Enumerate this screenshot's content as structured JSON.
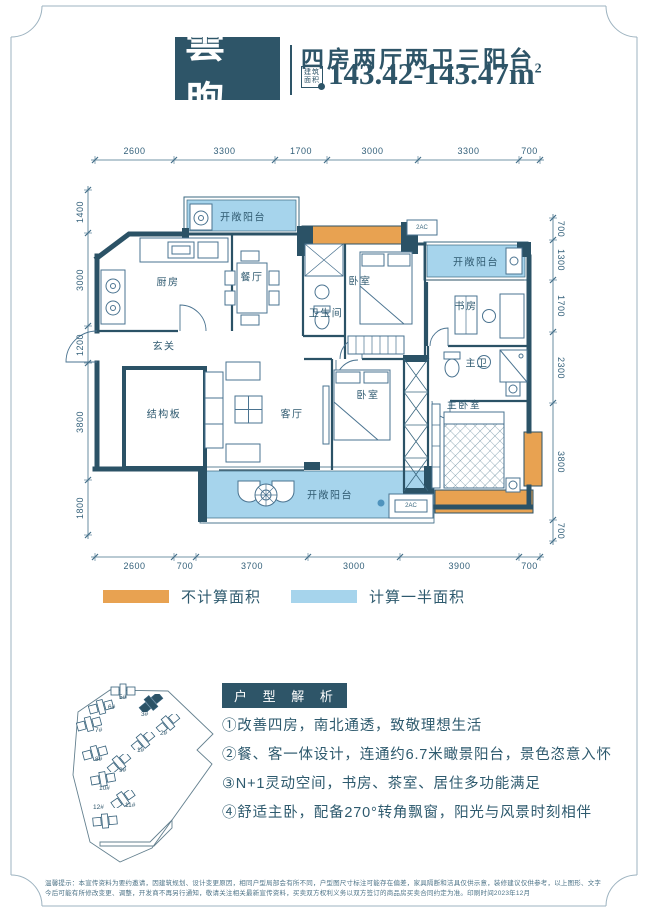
{
  "header": {
    "logo": "雲煦",
    "title": "四房两厅两卫三阳台",
    "badge_top": "建筑",
    "badge_bottom": "面积",
    "area": "143.42-143.47m",
    "area_sup": "2"
  },
  "plan": {
    "dims": {
      "top": {
        "y": 160,
        "ticks": [
          95,
          174,
          275,
          327,
          418,
          519,
          540
        ],
        "labels": [
          "2600",
          "3300",
          "1700",
          "3000",
          "3300",
          "700"
        ]
      },
      "bottom": {
        "y": 557,
        "ticks": [
          95,
          174,
          196,
          308,
          400,
          519,
          540
        ],
        "labels": [
          "2600",
          "700",
          "3700",
          "3000",
          "3900",
          "700"
        ]
      },
      "left": {
        "x": 88,
        "ticks": [
          190,
          233,
          326,
          363,
          480,
          535
        ],
        "labels": [
          "1400",
          "3000",
          "1200",
          "3800",
          "1800"
        ]
      },
      "right": {
        "x": 553,
        "ticks": [
          218,
          240,
          280,
          332,
          403,
          520,
          541
        ],
        "labels": [
          "700",
          "1300",
          "1700",
          "2300",
          "3800",
          "700"
        ]
      }
    },
    "rooms": [
      {
        "t": "开敞阳台",
        "x": 243,
        "y": 216
      },
      {
        "t": "厨房",
        "x": 168,
        "y": 281
      },
      {
        "t": "餐厅",
        "x": 252,
        "y": 276
      },
      {
        "t": "卧室",
        "x": 360,
        "y": 280
      },
      {
        "t": "卫生间",
        "x": 326,
        "y": 312
      },
      {
        "t": "开敞阳台",
        "x": 476,
        "y": 261
      },
      {
        "t": "书房",
        "x": 466,
        "y": 305
      },
      {
        "t": "玄关",
        "x": 164,
        "y": 345
      },
      {
        "t": "结构板",
        "x": 164,
        "y": 413
      },
      {
        "t": "客厅",
        "x": 292,
        "y": 413
      },
      {
        "t": "卧室",
        "x": 368,
        "y": 394
      },
      {
        "t": "主卫",
        "x": 477,
        "y": 362
      },
      {
        "t": "主卧室",
        "x": 464,
        "y": 404
      },
      {
        "t": "开敞阳台",
        "x": 330,
        "y": 494
      },
      {
        "t": "2AC",
        "x": 422,
        "y": 228,
        "s": 1
      },
      {
        "t": "2AC",
        "x": 411,
        "y": 506,
        "s": 1
      }
    ]
  },
  "legend": [
    {
      "color": "#e8a251",
      "label": "不计算面积"
    },
    {
      "color": "#a6d4ec",
      "label": "计算一半面积"
    }
  ],
  "site": {
    "buildings": [
      {
        "t": "5#",
        "lx": 119,
        "ly": 694,
        "ix": 110,
        "iy": 682,
        "rot": 0,
        "dark": false
      },
      {
        "t": "6#",
        "lx": 108,
        "ly": 704,
        "ix": 88,
        "iy": 698,
        "rot": -15,
        "dark": false
      },
      {
        "t": "3#",
        "lx": 141,
        "ly": 711,
        "ix": 138,
        "iy": 694,
        "rot": -40,
        "dark": true
      },
      {
        "t": "2#",
        "lx": 160,
        "ly": 730,
        "ix": 155,
        "iy": 714,
        "rot": -40,
        "dark": false
      },
      {
        "t": "7#",
        "lx": 95,
        "ly": 727,
        "ix": 76,
        "iy": 715,
        "rot": -15,
        "dark": false
      },
      {
        "t": "1#",
        "lx": 137,
        "ly": 747,
        "ix": 130,
        "iy": 732,
        "rot": -40,
        "dark": false
      },
      {
        "t": "8#",
        "lx": 95,
        "ly": 756,
        "ix": 82,
        "iy": 744,
        "rot": -15,
        "dark": false
      },
      {
        "t": "9#",
        "lx": 119,
        "ly": 767,
        "ix": 106,
        "iy": 754,
        "rot": -40,
        "dark": false
      },
      {
        "t": "10#",
        "lx": 99,
        "ly": 785,
        "ix": 90,
        "iy": 770,
        "rot": -10,
        "dark": false
      },
      {
        "t": "11#",
        "lx": 125,
        "ly": 802,
        "ix": 110,
        "iy": 790,
        "rot": -35,
        "dark": false
      },
      {
        "t": "12#",
        "lx": 93,
        "ly": 804,
        "ix": 92,
        "iy": 812,
        "rot": -5,
        "dark": false
      }
    ]
  },
  "analysis": {
    "title": "户 型 解 析",
    "items": [
      "①改善四房，南北通透，致敬理想生活",
      "②餐、客一体设计，连通约6.7米瞰景阳台，景色恣意入怀",
      "③N+1灵动空间，书房、茶室、居住多功能满足",
      "④舒适主卧，配备270°转角飘窗，阳光与风景时刻相伴"
    ]
  },
  "disclaimer": "温馨提示：本宣传资料为要约邀请，因建筑规划、设计变更原因，相同户型局部会有所不同，户型图尺寸标注可能存在偏差，家具隔断和洁具仅供示意，装修建议仅供参考，以上图形、文字今后可能有所修改变更、调整，开发商不再另行通知，敬请关注相关最新宣传资料，买卖双方权利义务以双方签订的商品房买卖合同约定为准。印刷时间2023年12月",
  "colors": {
    "brand": "#2e5568",
    "wall": "#2b5266",
    "orange": "#e8a251",
    "blue": "#a6d4ec"
  }
}
